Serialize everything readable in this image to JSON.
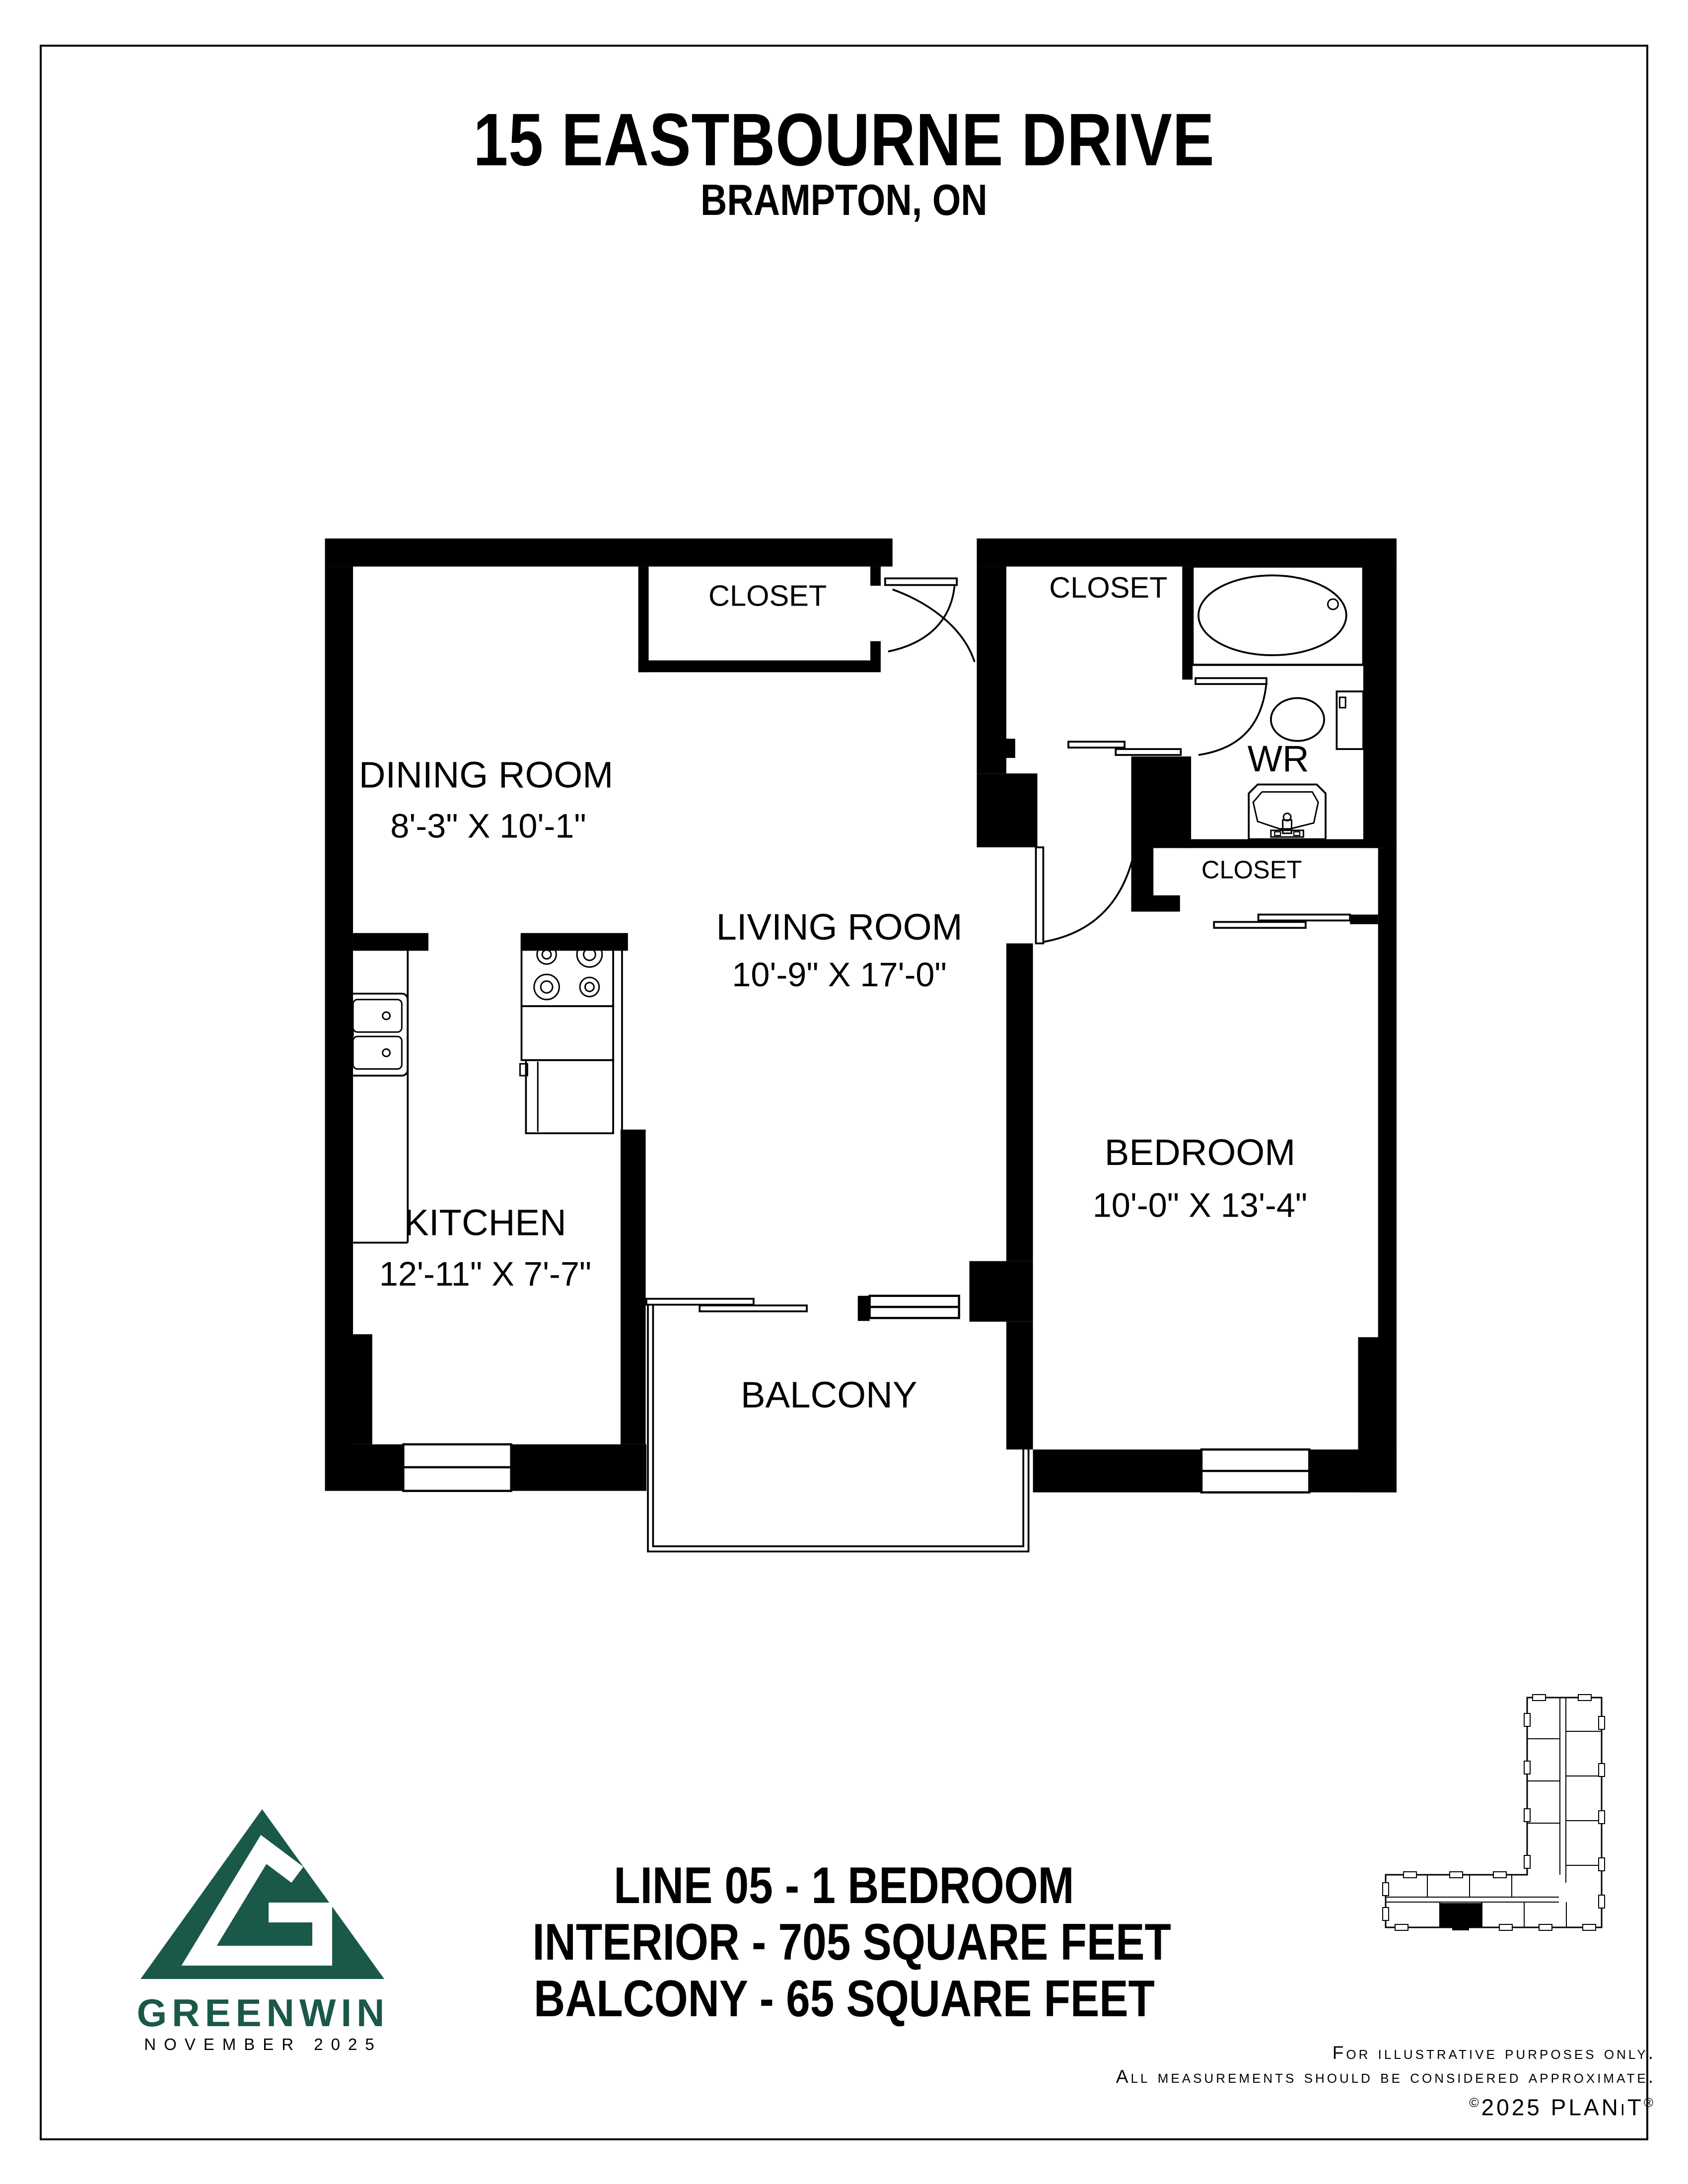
{
  "header": {
    "title": "15 EASTBOURNE DRIVE",
    "subtitle": "BRAMPTON, ON"
  },
  "floorplan": {
    "dining_room": {
      "name": "DINING ROOM",
      "dims": "8'-3\" X 10'-1\""
    },
    "living_room": {
      "name": "LIVING ROOM",
      "dims": "10'-9\" X 17'-0\""
    },
    "kitchen": {
      "name": "KITCHEN",
      "dims": "12'-11\" X 7'-7\""
    },
    "bedroom": {
      "name": "BEDROOM",
      "dims": "10'-0\" X 13'-4\""
    },
    "washroom": {
      "name": "WR"
    },
    "balcony": {
      "name": "BALCONY"
    },
    "closet_dining": {
      "name": "CLOSET"
    },
    "closet_hall": {
      "name": "CLOSET"
    },
    "closet_bedroom": {
      "name": "CLOSET"
    }
  },
  "summary": {
    "line1": "LINE 05 - 1 BEDROOM",
    "line2": "INTERIOR - 705 SQUARE FEET",
    "line3": "BALCONY - 65 SQUARE FEET"
  },
  "branding": {
    "company": "GREENWIN",
    "date": "NOVEMBER 2025",
    "logo_color": "#1a584a"
  },
  "legal": {
    "line1": "For illustrative purposes only.",
    "line2": "All measurements should be considered approximate.",
    "copyright_symbol": "©",
    "line3": "2025 PLANiT",
    "registered_symbol": "®"
  }
}
